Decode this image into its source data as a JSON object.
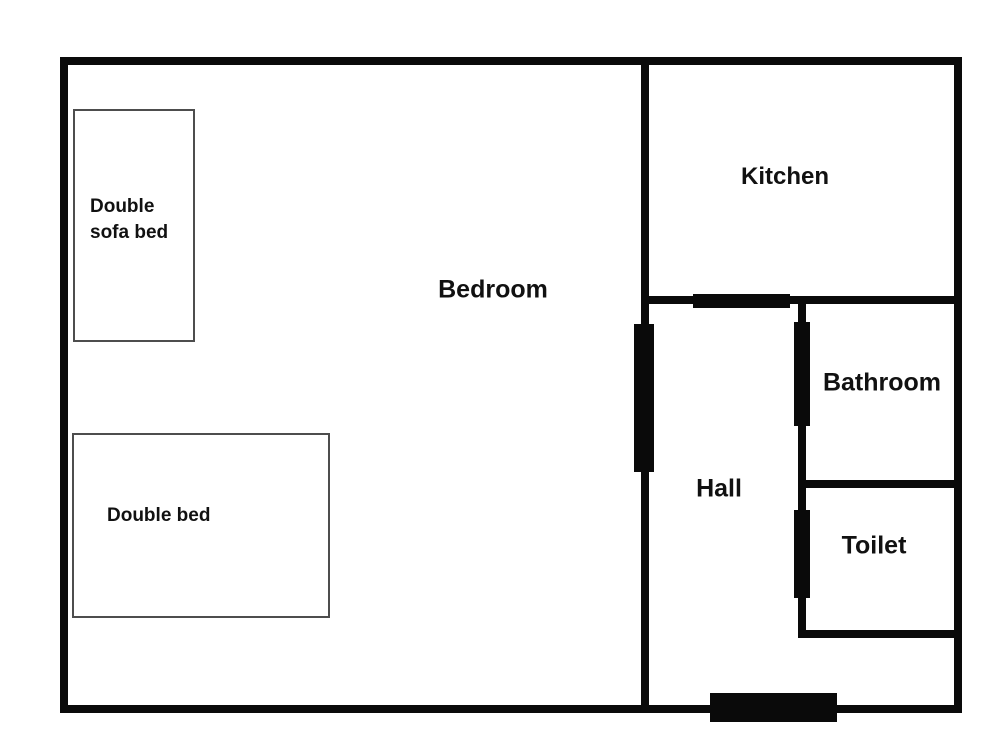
{
  "rooms": {
    "bedroom": "Bedroom",
    "kitchen": "Kitchen",
    "hall": "Hall",
    "bathroom": "Bathroom",
    "toilet": "Toilet"
  },
  "furniture": {
    "sofa_bed": "Double sofa bed",
    "double_bed": "Double bed"
  },
  "colors": {
    "wall": "#0a0a0a",
    "background": "#ffffff",
    "furniture_border": "#4d4d4d",
    "text": "#111111"
  }
}
